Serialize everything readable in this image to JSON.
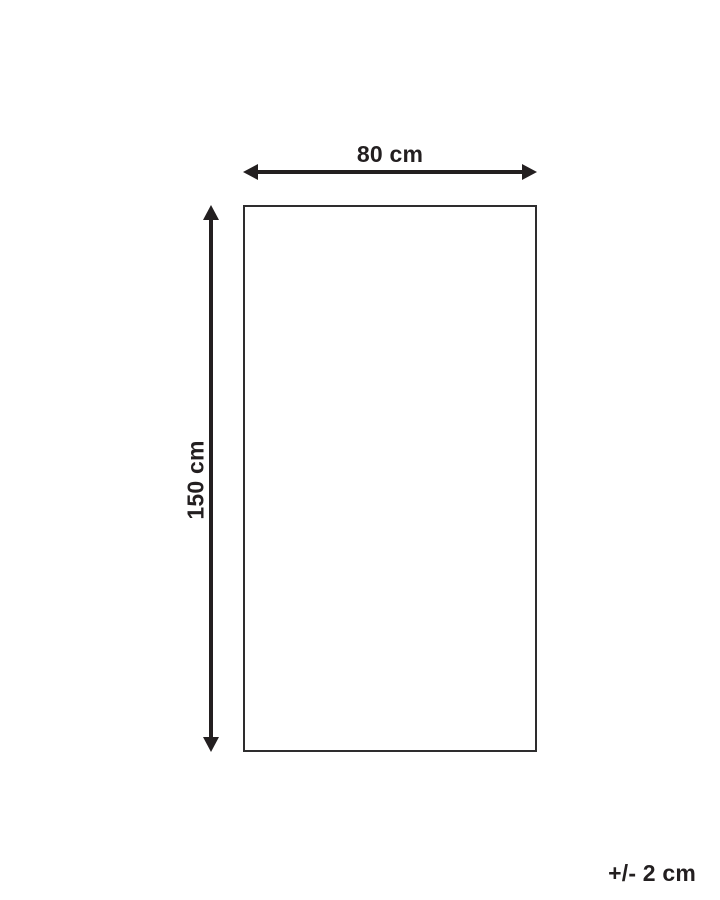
{
  "diagram": {
    "type": "product-dimension-diagram",
    "shape": "rectangle",
    "width_label": "80 cm",
    "height_label": "150 cm",
    "tolerance_label": "+/- 2 cm",
    "colors": {
      "arrow_and_text": "#231f20",
      "outline": "#2e2d2e",
      "background": "#ffffff"
    }
  }
}
